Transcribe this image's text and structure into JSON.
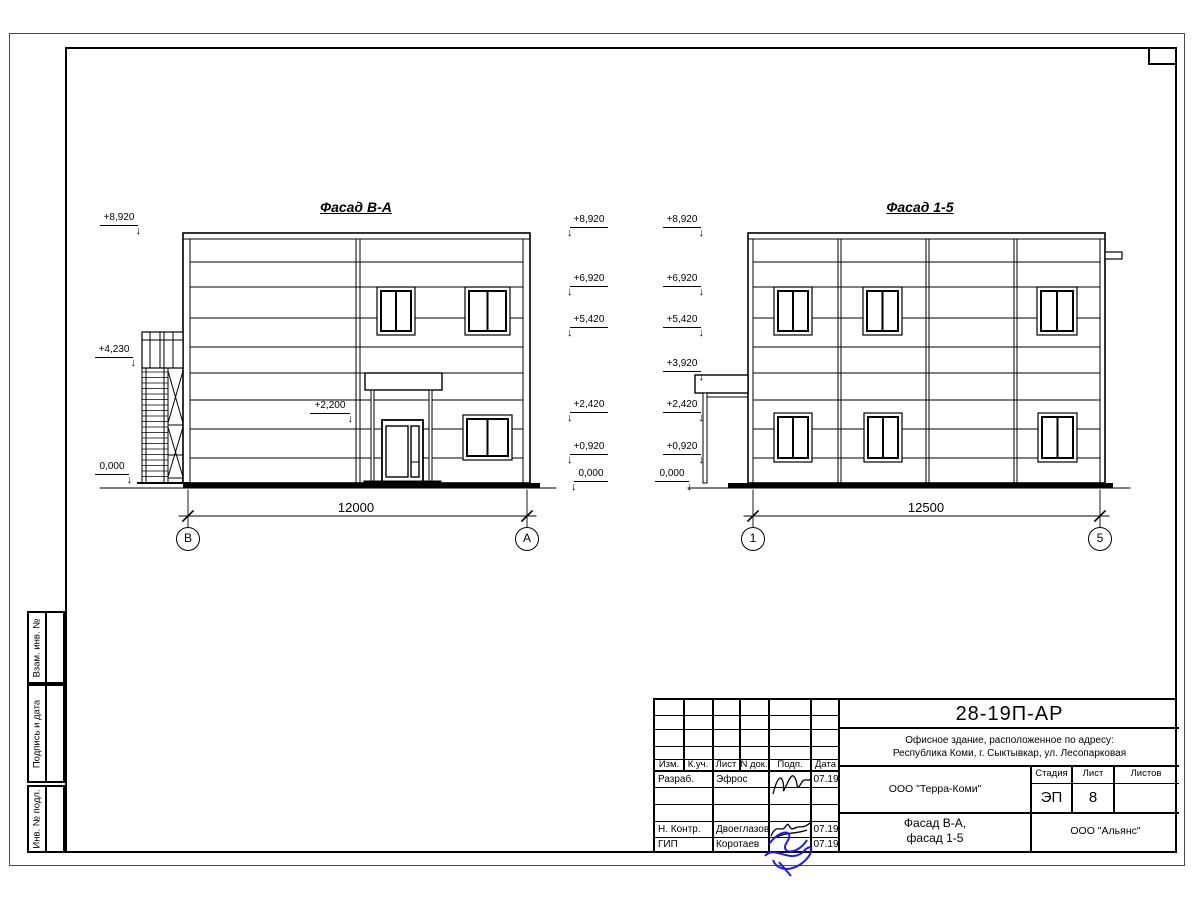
{
  "drawing": {
    "facade_left": {
      "title": "Фасад В-А",
      "dimension": "12000",
      "axes": [
        "В",
        "А"
      ],
      "levels_far_left": [
        "+8,920",
        "+4,230",
        "0,000"
      ],
      "level_entry": "+2,200",
      "levels_right_col": [
        "+8,920",
        "+6,920",
        "+5,420",
        "+2,420",
        "+0,920",
        "0,000"
      ]
    },
    "facade_right": {
      "title": "Фасад 1-5",
      "dimension": "12500",
      "axes": [
        "1",
        "5"
      ],
      "levels_left_col": [
        "+8,920",
        "+6,920",
        "+5,420",
        "+3,920",
        "+2,420",
        "+0,920",
        "0,000"
      ]
    }
  },
  "stamp": {
    "doc_code": "28-19П-АР",
    "description_line1": "Офисное здание, расположенное по адресу:",
    "description_line2": "Республика Коми, г. Сыктывкар, ул. Лесопарковая",
    "organization": "ООО \"Терра-Коми\"",
    "sheet_title_line1": "Фасад В-А,",
    "sheet_title_line2": "фасад 1-5",
    "contractor": "ООО \"Альянс\"",
    "cols": {
      "izm": "Изм.",
      "kuch": "К.уч.",
      "list": "Лист",
      "ndok": "N док.",
      "podp": "Подп.",
      "data": "Дата"
    },
    "stage_label": "Стадия",
    "sheet_label": "Лист",
    "sheets_label": "Листов",
    "stage_value": "ЭП",
    "sheet_value": "8",
    "sheets_value": "",
    "rows": [
      {
        "role": "Разраб.",
        "name": "Эфрос",
        "date": "07.19"
      },
      {
        "role": "Н. Контр.",
        "name": "Двоеглазов",
        "date": "07.19"
      },
      {
        "role": "ГИП",
        "name": "Коротаев",
        "date": "07.19"
      }
    ]
  },
  "side_panel": {
    "labels": [
      "Взам. инв. №",
      "Подпись и дата",
      "Инв. № подл."
    ]
  },
  "colors": {
    "line": "#000000",
    "signature_blue": "#1b1bee"
  }
}
